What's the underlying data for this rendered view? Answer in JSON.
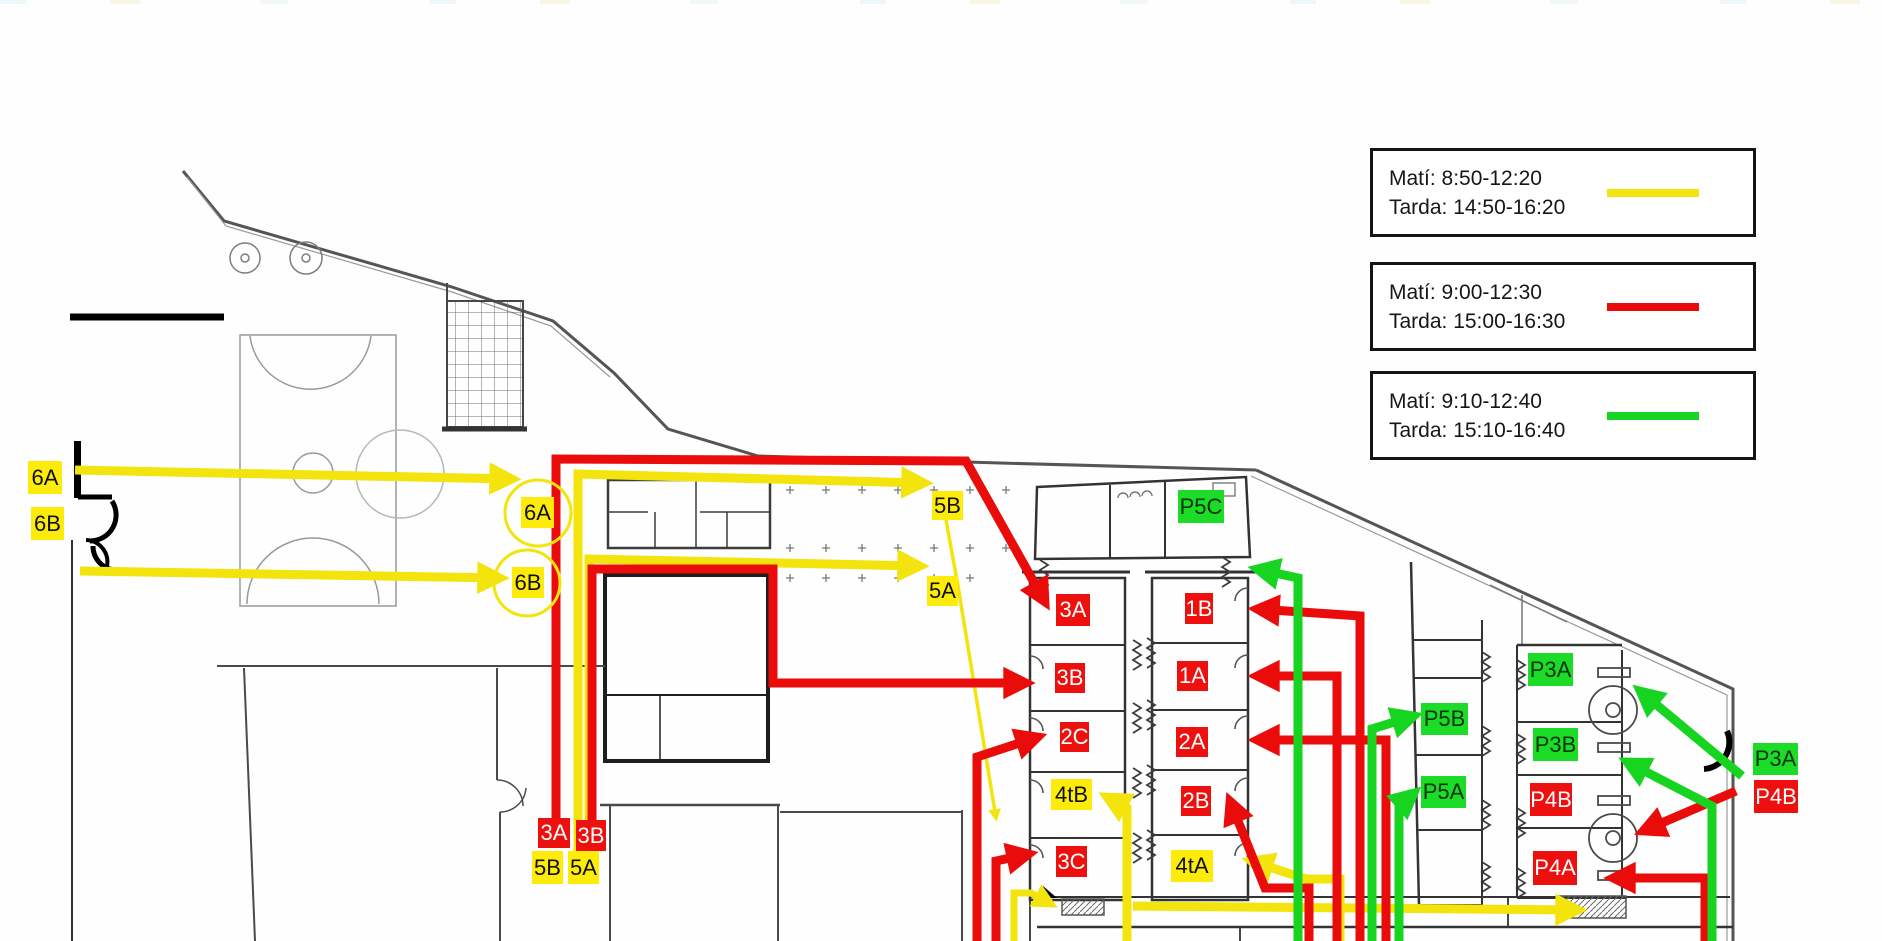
{
  "legend": {
    "entries": [
      {
        "id": "yellow-schedule",
        "line1": "Matí: 8:50-12:20",
        "line2": "Tarda: 14:50-16:20",
        "color_group": "yellow"
      },
      {
        "id": "red-schedule",
        "line1": "Matí: 9:00-12:30",
        "line2": "Tarda: 15:00-16:30",
        "color_group": "red"
      },
      {
        "id": "green-schedule",
        "line1": "Matí: 9:10-12:40",
        "line2": "Tarda: 15:10-16:40",
        "color_group": "green"
      }
    ]
  },
  "colors": {
    "yellow": "#f2e40c",
    "red": "#ea0b0b",
    "green": "#16d41f",
    "label_yellow_bg": "#fdec09",
    "label_red_bg": "#ee100e",
    "label_green_bg": "#1cdc28",
    "legend_border": "#141414",
    "plan_wall": "#4a4a4a"
  },
  "class_labels": [
    {
      "id": "6A-entry",
      "text": "6A",
      "color": "yellow",
      "x": 28,
      "y": 461,
      "w": 34,
      "h": 33
    },
    {
      "id": "6B-entry",
      "text": "6B",
      "color": "yellow",
      "x": 31,
      "y": 507,
      "w": 33,
      "h": 33
    },
    {
      "id": "6A-court",
      "text": "6A",
      "color": "yellow",
      "x": 521,
      "y": 497,
      "w": 33,
      "h": 31
    },
    {
      "id": "6B-court",
      "text": "6B",
      "color": "yellow",
      "x": 512,
      "y": 567,
      "w": 32,
      "h": 31
    },
    {
      "id": "5B-mid",
      "text": "5B",
      "color": "yellow",
      "x": 932,
      "y": 491,
      "w": 31,
      "h": 29
    },
    {
      "id": "5A-mid",
      "text": "5A",
      "color": "yellow",
      "x": 927,
      "y": 576,
      "w": 31,
      "h": 30
    },
    {
      "id": "5B-entry",
      "text": "5B",
      "color": "yellow",
      "x": 532,
      "y": 851,
      "w": 31,
      "h": 33
    },
    {
      "id": "5A-entry",
      "text": "5A",
      "color": "yellow",
      "x": 568,
      "y": 851,
      "w": 31,
      "h": 33
    },
    {
      "id": "4tB-room",
      "text": "4tB",
      "color": "yellow",
      "x": 1051,
      "y": 779,
      "w": 41,
      "h": 31
    },
    {
      "id": "4tA-room",
      "text": "4tA",
      "color": "yellow",
      "x": 1171,
      "y": 850,
      "w": 42,
      "h": 32
    },
    {
      "id": "3A-room",
      "text": "3A",
      "color": "red",
      "x": 1056,
      "y": 594,
      "w": 34,
      "h": 32
    },
    {
      "id": "1B-room",
      "text": "1B",
      "color": "red",
      "x": 1185,
      "y": 593,
      "w": 28,
      "h": 31
    },
    {
      "id": "3B-room",
      "text": "3B",
      "color": "red",
      "x": 1055,
      "y": 663,
      "w": 30,
      "h": 30
    },
    {
      "id": "1A-room",
      "text": "1A",
      "color": "red",
      "x": 1177,
      "y": 661,
      "w": 31,
      "h": 30
    },
    {
      "id": "2C-room",
      "text": "2C",
      "color": "red",
      "x": 1060,
      "y": 722,
      "w": 29,
      "h": 30
    },
    {
      "id": "2A-room",
      "text": "2A",
      "color": "red",
      "x": 1176,
      "y": 727,
      "w": 32,
      "h": 30
    },
    {
      "id": "2B-room",
      "text": "2B",
      "color": "red",
      "x": 1181,
      "y": 786,
      "w": 30,
      "h": 30
    },
    {
      "id": "3C-room",
      "text": "3C",
      "color": "red",
      "x": 1056,
      "y": 846,
      "w": 31,
      "h": 31
    },
    {
      "id": "3A-entry",
      "text": "3A",
      "color": "red",
      "x": 538,
      "y": 818,
      "w": 32,
      "h": 30
    },
    {
      "id": "3B-entry",
      "text": "3B",
      "color": "red",
      "x": 576,
      "y": 820,
      "w": 30,
      "h": 31
    },
    {
      "id": "P4B-room",
      "text": "P4B",
      "color": "red",
      "x": 1530,
      "y": 783,
      "w": 42,
      "h": 33
    },
    {
      "id": "P4A-room",
      "text": "P4A",
      "color": "red",
      "x": 1533,
      "y": 851,
      "w": 44,
      "h": 34
    },
    {
      "id": "P4B-entry",
      "text": "P4B",
      "color": "red",
      "x": 1754,
      "y": 780,
      "w": 44,
      "h": 33
    },
    {
      "id": "P5C-room",
      "text": "P5C",
      "color": "green",
      "x": 1178,
      "y": 490,
      "w": 46,
      "h": 33
    },
    {
      "id": "P5B-room",
      "text": "P5B",
      "color": "green",
      "x": 1421,
      "y": 703,
      "w": 47,
      "h": 32
    },
    {
      "id": "P5A-room",
      "text": "P5A",
      "color": "green",
      "x": 1421,
      "y": 776,
      "w": 45,
      "h": 32
    },
    {
      "id": "P3A-room",
      "text": "P3A",
      "color": "green",
      "x": 1528,
      "y": 653,
      "w": 45,
      "h": 33
    },
    {
      "id": "P3B-room",
      "text": "P3B",
      "color": "green",
      "x": 1533,
      "y": 728,
      "w": 45,
      "h": 33
    },
    {
      "id": "P3A-entry",
      "text": "P3A",
      "color": "green",
      "x": 1753,
      "y": 743,
      "w": 45,
      "h": 32
    }
  ],
  "label_circles": [
    {
      "id": "6A-court-circle",
      "cx": 538,
      "cy": 513,
      "r": 33
    },
    {
      "id": "6B-court-circle",
      "cx": 527,
      "cy": 583,
      "r": 33
    }
  ],
  "routes": [
    {
      "id": "6A",
      "group": "yellow",
      "points": [
        [
          75,
          470
        ],
        [
          512,
          479
        ]
      ]
    },
    {
      "id": "6B",
      "group": "yellow",
      "points": [
        [
          80,
          571
        ],
        [
          500,
          578
        ]
      ]
    },
    {
      "id": "5B",
      "group": "yellow",
      "points": [
        [
          578,
          854
        ],
        [
          578,
          474
        ],
        [
          924,
          483
        ]
      ]
    },
    {
      "id": "5A",
      "group": "yellow",
      "points": [
        [
          589,
          854
        ],
        [
          589,
          559
        ],
        [
          920,
          566
        ]
      ]
    },
    {
      "id": "5-branch-thin",
      "group": "yellow",
      "width": 3.5,
      "points": [
        [
          946,
          520
        ],
        [
          958,
          586
        ],
        [
          996,
          818
        ]
      ]
    },
    {
      "id": "4tB",
      "group": "yellow",
      "points": [
        [
          1127,
          941
        ],
        [
          1127,
          808
        ],
        [
          1107,
          797
        ]
      ]
    },
    {
      "id": "4t-corridor",
      "group": "yellow",
      "points": [
        [
          1133,
          906
        ],
        [
          1578,
          910
        ]
      ]
    },
    {
      "id": "4t-stair",
      "group": "yellow",
      "width": 7,
      "points": [
        [
          1014,
          941
        ],
        [
          1014,
          893
        ],
        [
          1031,
          893
        ],
        [
          1051,
          904
        ]
      ]
    },
    {
      "id": "4tA",
      "group": "yellow",
      "points": [
        [
          1340,
          941
        ],
        [
          1340,
          879
        ],
        [
          1306,
          879
        ],
        [
          1251,
          861
        ]
      ]
    },
    {
      "id": "3A",
      "group": "red",
      "points": [
        [
          556,
          821
        ],
        [
          556,
          459
        ],
        [
          966,
          461
        ],
        [
          1045,
          602
        ]
      ]
    },
    {
      "id": "3B",
      "group": "red",
      "points": [
        [
          592,
          823
        ],
        [
          592,
          569
        ],
        [
          773,
          569
        ],
        [
          773,
          683
        ],
        [
          1026,
          683
        ]
      ]
    },
    {
      "id": "2C",
      "group": "red",
      "points": [
        [
          977,
          941
        ],
        [
          977,
          757
        ],
        [
          1038,
          737
        ]
      ]
    },
    {
      "id": "3C",
      "group": "red",
      "points": [
        [
          996,
          941
        ],
        [
          996,
          861
        ],
        [
          1029,
          854
        ]
      ]
    },
    {
      "id": "1B",
      "group": "red",
      "points": [
        [
          1360,
          941
        ],
        [
          1360,
          616
        ],
        [
          1257,
          609
        ]
      ]
    },
    {
      "id": "1A",
      "group": "red",
      "points": [
        [
          1337,
          941
        ],
        [
          1337,
          676
        ],
        [
          1257,
          676
        ]
      ]
    },
    {
      "id": "2A",
      "group": "red",
      "points": [
        [
          1386,
          941
        ],
        [
          1386,
          740
        ],
        [
          1257,
          740
        ]
      ]
    },
    {
      "id": "2B",
      "group": "red",
      "points": [
        [
          1309,
          941
        ],
        [
          1309,
          888
        ],
        [
          1265,
          888
        ],
        [
          1230,
          801
        ]
      ]
    },
    {
      "id": "P4B-door",
      "group": "red",
      "points": [
        [
          1736,
          791
        ],
        [
          1643,
          831
        ]
      ]
    },
    {
      "id": "P4A",
      "group": "red",
      "points": [
        [
          1705,
          941
        ],
        [
          1705,
          878
        ],
        [
          1613,
          878
        ]
      ]
    },
    {
      "id": "P5C-corridor",
      "group": "green",
      "points": [
        [
          1298,
          941
        ],
        [
          1298,
          578
        ],
        [
          1257,
          569
        ]
      ]
    },
    {
      "id": "P5B",
      "group": "green",
      "points": [
        [
          1372,
          941
        ],
        [
          1372,
          729
        ],
        [
          1414,
          716
        ]
      ]
    },
    {
      "id": "P5A",
      "group": "green",
      "points": [
        [
          1399,
          941
        ],
        [
          1399,
          806
        ],
        [
          1414,
          793
        ]
      ]
    },
    {
      "id": "P3A-door",
      "group": "green",
      "points": [
        [
          1742,
          776
        ],
        [
          1640,
          691
        ]
      ]
    },
    {
      "id": "P3-stair",
      "group": "green",
      "points": [
        [
          1712,
          941
        ],
        [
          1712,
          806
        ],
        [
          1627,
          762
        ]
      ]
    }
  ]
}
